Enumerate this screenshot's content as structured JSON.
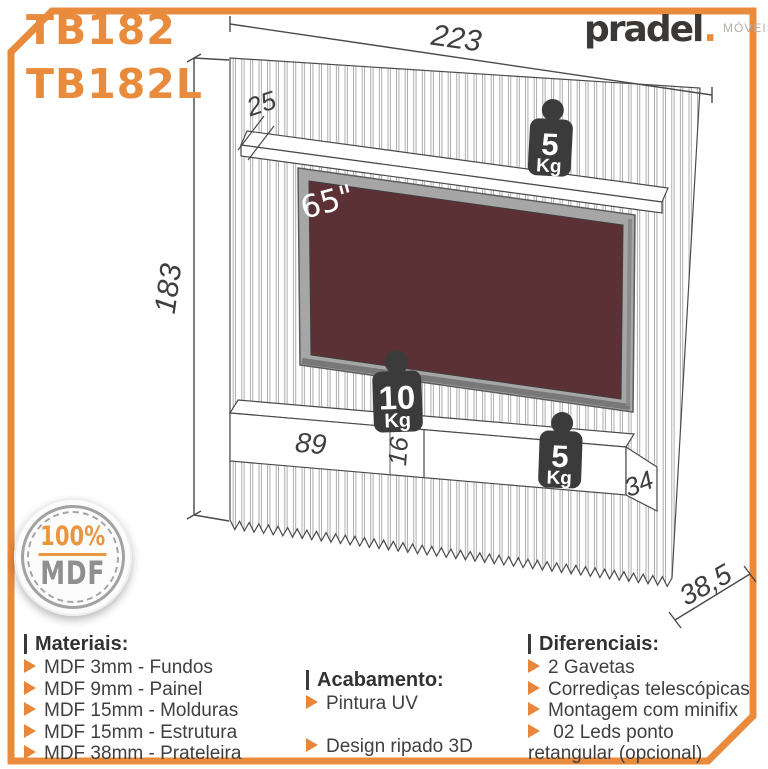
{
  "header": {
    "model_1": "TB182",
    "model_2": "TB182L",
    "brand": "pradel",
    "brand_dot": ".",
    "brand_suffix": "MÓVEIS"
  },
  "diagram": {
    "dims": {
      "width": "223",
      "height": "183",
      "shelf_depth": "25",
      "drawer_width": "89",
      "drawer_height": "16",
      "side_depth": "34",
      "base_depth": "38,5"
    },
    "tv_size": "65\"",
    "weights": {
      "top_shelf": {
        "value": "5",
        "unit": "Kg"
      },
      "tv_mount": {
        "value": "10",
        "unit": "Kg"
      },
      "bottom_shelf": {
        "value": "5",
        "unit": "Kg"
      }
    }
  },
  "seal": {
    "line1": "100%",
    "line2": "MDF"
  },
  "sections": {
    "materials": {
      "title": "Materiais:",
      "items": [
        "MDF 3mm - Fundos",
        "MDF 9mm - Painel",
        "MDF 15mm - Molduras",
        "MDF 15mm - Estrutura",
        "MDF 38mm - Prateleira"
      ]
    },
    "finish": {
      "title": "Acabamento:",
      "items": [
        "Pintura UV",
        "Design ripado 3D"
      ]
    },
    "differentials": {
      "title": "Diferenciais:",
      "items": [
        "2 Gavetas",
        "Corrediças telescópicas",
        "Montagem com minifix",
        " 02 Leds ponto retangular (opcional)"
      ]
    }
  },
  "colors": {
    "accent": "#e98b3d",
    "line": "#4a4a4a",
    "tv_screen": "#5c3136",
    "badge": "#3b3b3b"
  }
}
